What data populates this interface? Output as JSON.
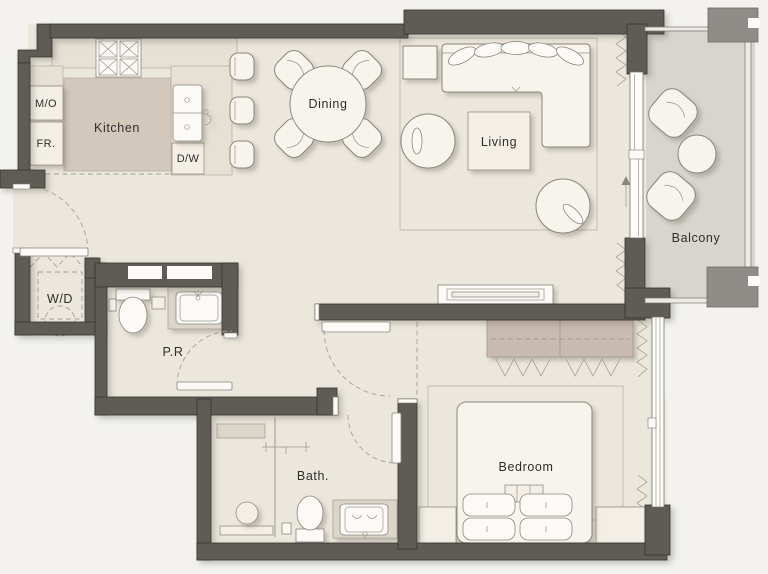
{
  "rooms": {
    "kitchen": "Kitchen",
    "dining": "Dining",
    "living": "Living",
    "balcony": "Balcony",
    "bedroom": "Bedroom",
    "bath": "Bath.",
    "powder_room": "P.R",
    "washer_dryer": "W/D"
  },
  "appliances": {
    "microwave": "M/O",
    "fridge": "FR.",
    "dishwasher": "D/W"
  },
  "colors": {
    "wall": "#5e5c57",
    "wall_post": "#8f8d88",
    "floor": "#ece7dd",
    "balcony_floor": "#d8d4ce",
    "counter": "#e7e0d5",
    "island": "#d2c9bc",
    "wardrobe": "#c9bbaf",
    "vanity_top": "#dcd5ca",
    "furniture": "#f7f4ed",
    "background": "#f3f2ef",
    "outline": "#8b867c",
    "text": "#2f2e2b"
  }
}
